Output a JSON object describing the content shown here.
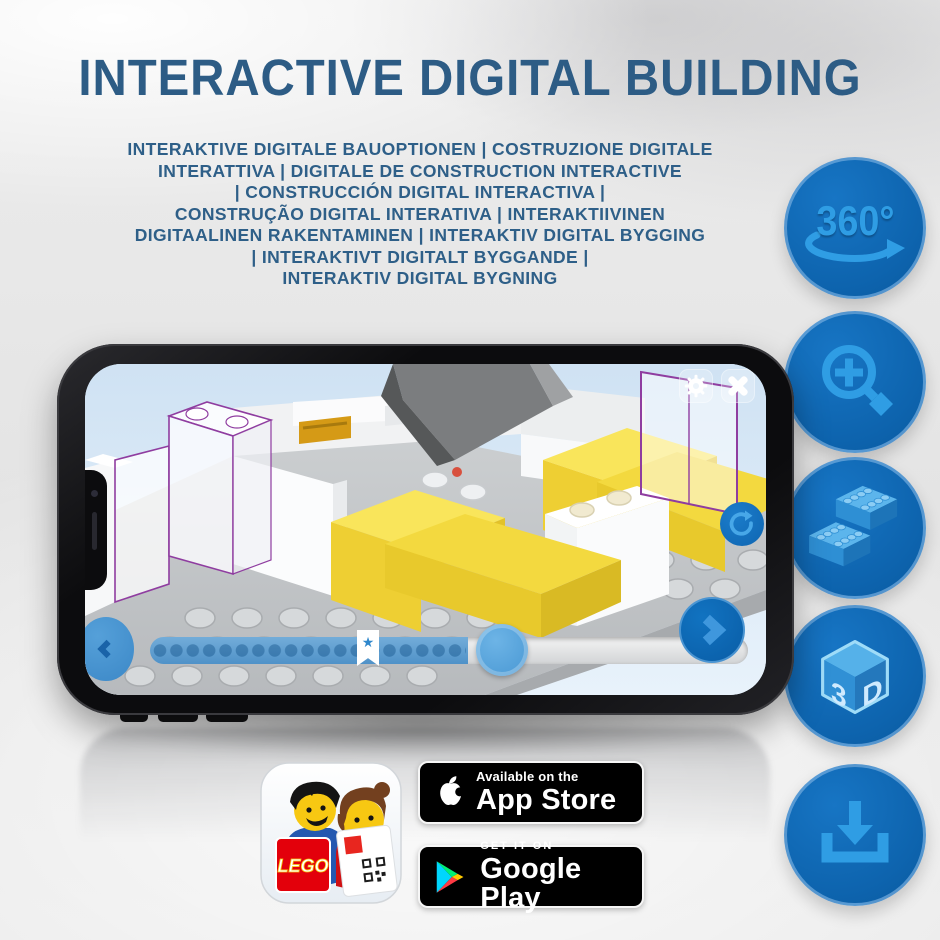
{
  "title": "INTERACTIVE DIGITAL BUILDING",
  "subtitle": {
    "lines": [
      "INTERAKTIVE DIGITALE BAUOPTIONEN | COSTRUZIONE DIGITALE",
      "INTERATTIVA | DIGITALE DE CONSTRUCTION INTERACTIVE",
      "| CONSTRUCCIÓN DIGITAL INTERACTIVA |",
      "CONSTRUÇÃO DIGITAL INTERATIVA | INTERAKTIIVINEN",
      "DIGITAALINEN RAKENTAMINEN | INTERAKTIV DIGITAL BYGGING",
      "| INTERAKTIVT DIGITALT BYGGANDE |",
      "INTERAKTIV DIGITAL BYGNING"
    ]
  },
  "features": {
    "rotation_label": "360°",
    "cube_left": "3",
    "cube_right": "D"
  },
  "store_badges": {
    "app_store": {
      "tagline": "Available on the",
      "store": "App Store"
    },
    "google_play": {
      "tagline": "GET IT ON",
      "store": "Google Play"
    }
  },
  "app_icon": {
    "lego_logo": "LEGO"
  },
  "colors": {
    "title_blue": "#2d5c85",
    "badge_circle_blue": "#0d63ad",
    "badge_icon_blue": "#2f9de4",
    "app_sky_blue": "#d6e7f5",
    "lego_yellow": "#f3d93f",
    "ghost_outline_purple": "#8f3da0",
    "slider_blue": "#4f92c8"
  }
}
